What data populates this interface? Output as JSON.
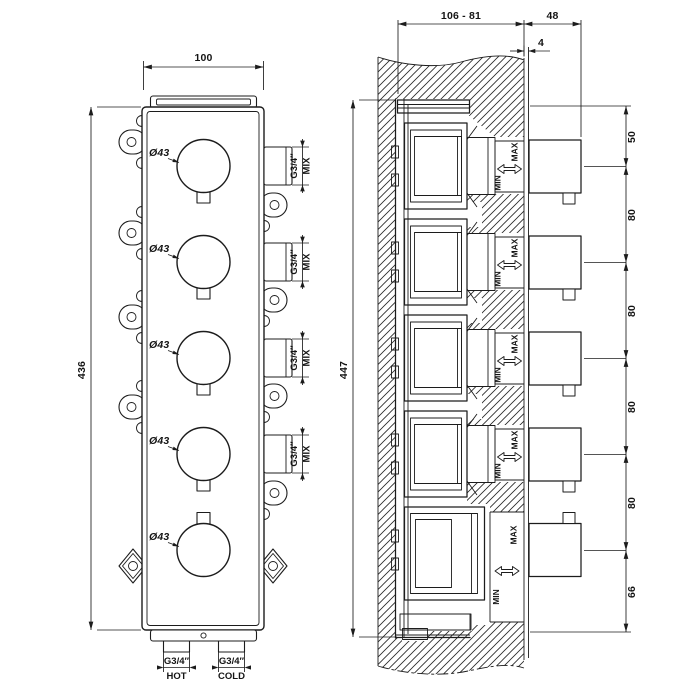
{
  "drawing": {
    "front": {
      "width_dim": "100",
      "height_dim": "436",
      "knobs": [
        {
          "dia": "Ø43"
        },
        {
          "dia": "Ø43"
        },
        {
          "dia": "Ø43"
        },
        {
          "dia": "Ø43"
        },
        {
          "dia": "Ø43"
        }
      ],
      "mix_ports": [
        {
          "thread": "G3/4″",
          "label": "MIX"
        },
        {
          "thread": "G3/4″",
          "label": "MIX"
        },
        {
          "thread": "G3/4″",
          "label": "MIX"
        },
        {
          "thread": "G3/4″",
          "label": "MIX"
        }
      ],
      "hot": {
        "thread": "G3/4″",
        "label": "HOT"
      },
      "cold": {
        "thread": "G3/4″",
        "label": "COLD"
      }
    },
    "section": {
      "depth_range_dim": "106 - 81",
      "knob_depth_dim": "48",
      "plate_thickness_dim": "4",
      "height_dim": "447",
      "spacing_dims": [
        "50",
        "80",
        "80",
        "80",
        "80",
        "66"
      ],
      "modules": [
        {
          "max": "MAX",
          "min": "MIN"
        },
        {
          "max": "MAX",
          "min": "MIN"
        },
        {
          "max": "MAX",
          "min": "MIN"
        },
        {
          "max": "MAX",
          "min": "MIN"
        },
        {
          "max": "MAX",
          "min": "MIN"
        }
      ]
    },
    "colors": {
      "ink": "#1c1c1c",
      "paper": "#ffffff"
    }
  }
}
